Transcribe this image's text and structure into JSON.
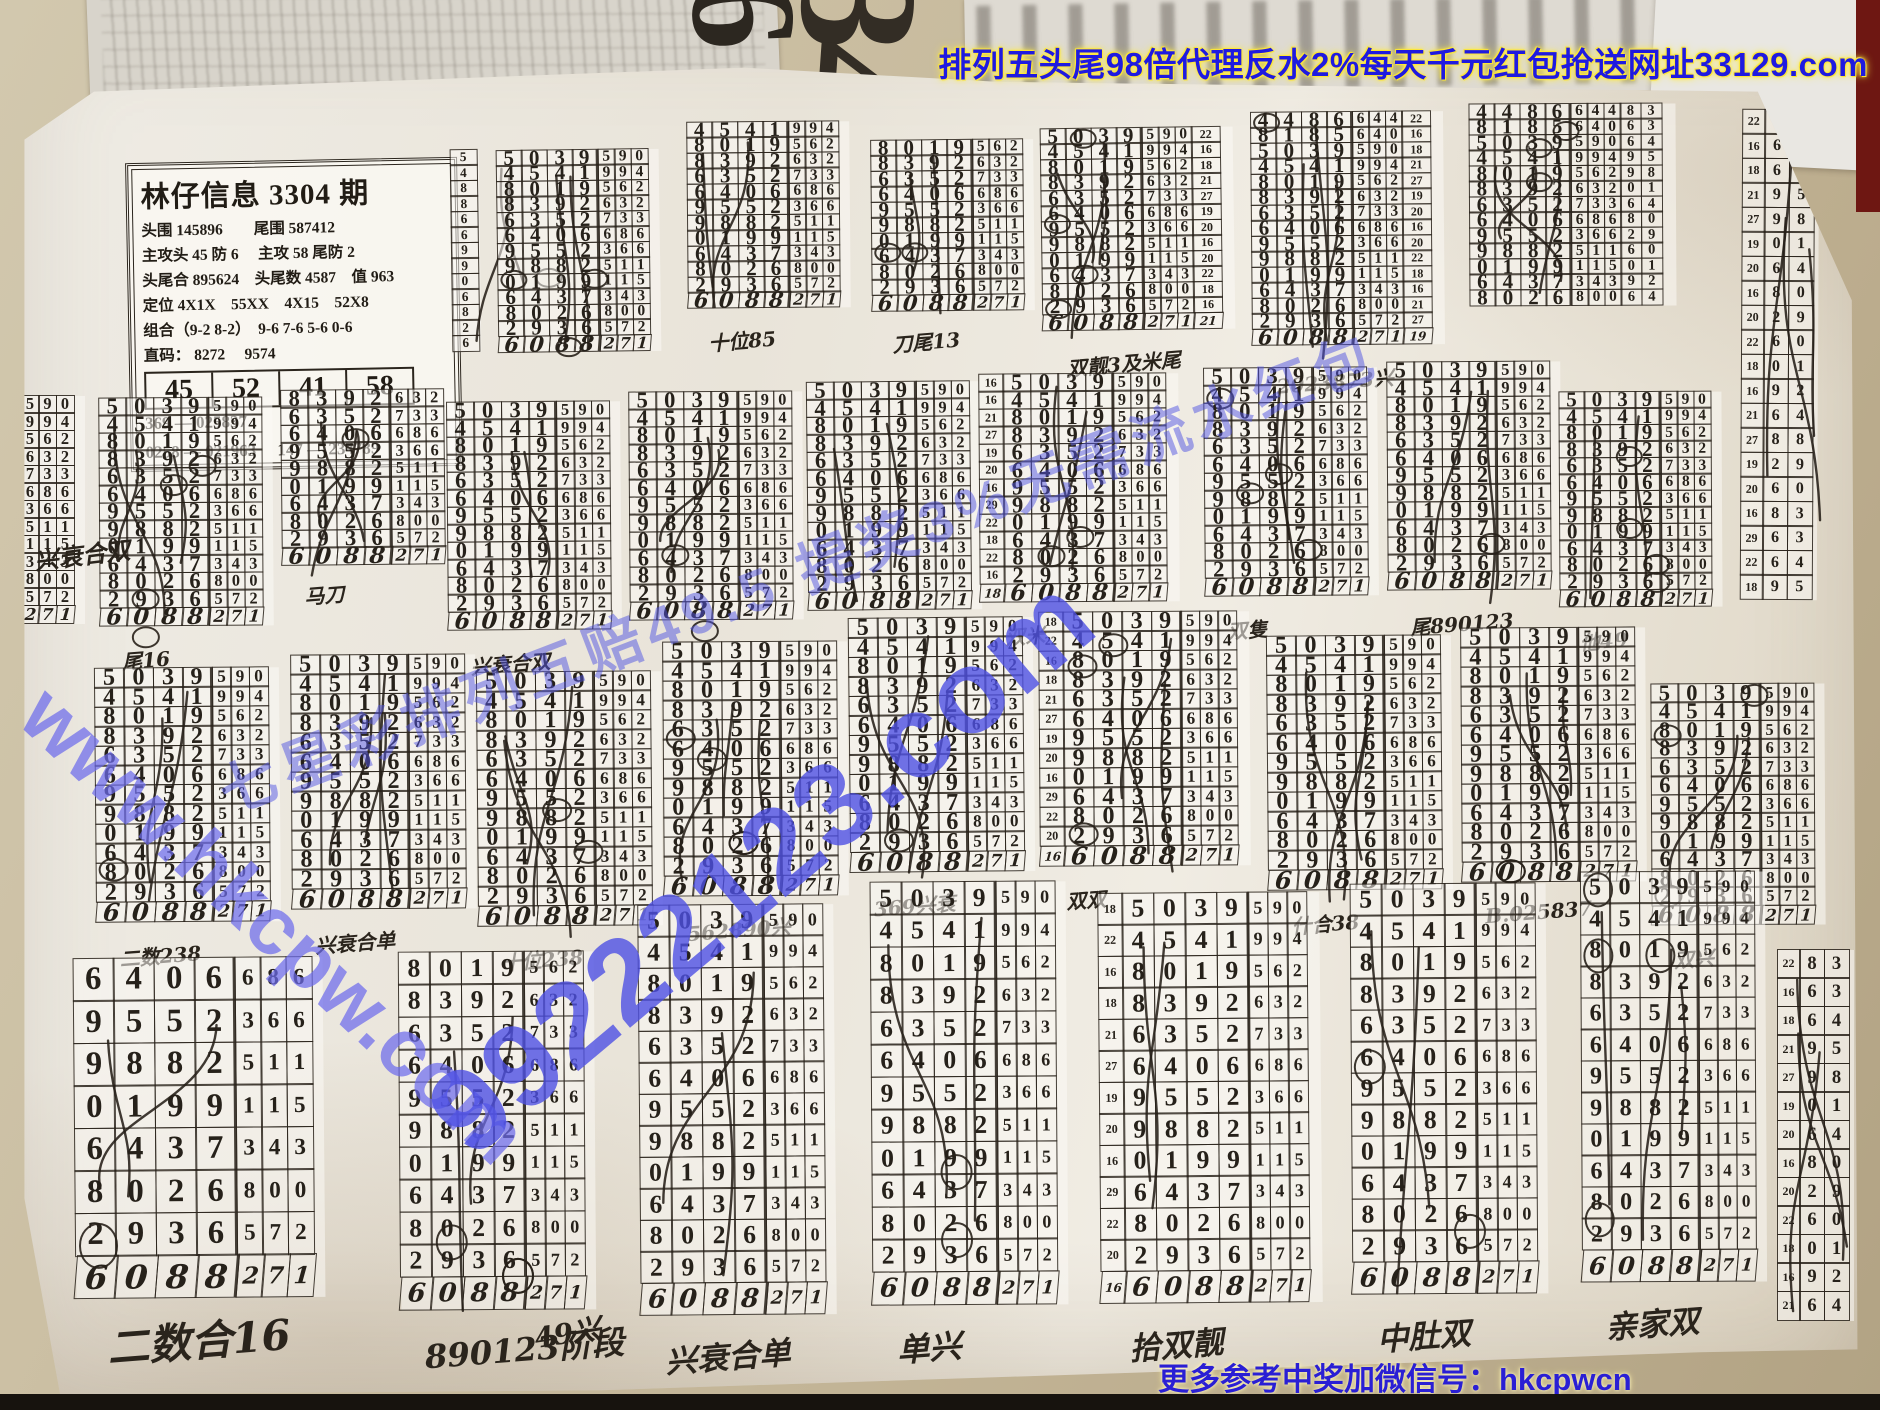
{
  "banner": {
    "text": "排列五头尾98倍代理反水2%每天千元红包抢送网址33129.com"
  },
  "footer": {
    "text": "更多参考中奖加微信号：hkcpwcn"
  },
  "watermarks": {
    "center": "99222123.com",
    "left": "www.hkcpw.com",
    "diagonal": "七星彩排列五赔49.5 提奖3%无需流水红包"
  },
  "scraps": {
    "big_digits": "34",
    "big_six": "6",
    "side_digits": "9 9 9"
  },
  "info_box": {
    "title": "林仔信息 3304 期",
    "lines": [
      "头围 145896　　尾围 587412",
      "主攻头 45 防 6　 主攻 58 尾防 2",
      "头尾合 895624　头尾数 4587　值 963",
      "定位 4X1X　55XX　4X15　52X8",
      "组合（9-2 8-2）　9-6 7-6 5-6 0-6",
      "直码： 8272　 9574"
    ],
    "highlight_cells": [
      "45",
      "52",
      "41",
      "58"
    ],
    "bottom_lines": [
      "369 — 025837",
      "0258 — 021963　 147 — 234789"
    ]
  },
  "grid": {
    "rows": [
      [
        "5",
        "0",
        "3",
        "9",
        "5",
        "9",
        "0"
      ],
      [
        "4",
        "5",
        "4",
        "1",
        "9",
        "9",
        "4"
      ],
      [
        "8",
        "0",
        "1",
        "9",
        "5",
        "6",
        "2"
      ],
      [
        "8",
        "3",
        "9",
        "2",
        "6",
        "3",
        "2"
      ],
      [
        "6",
        "3",
        "5",
        "2",
        "7",
        "3",
        "3"
      ],
      [
        "6",
        "4",
        "0",
        "6",
        "6",
        "8",
        "6"
      ],
      [
        "9",
        "5",
        "5",
        "2",
        "3",
        "6",
        "6"
      ],
      [
        "9",
        "8",
        "8",
        "2",
        "5",
        "1",
        "1"
      ],
      [
        "0",
        "1",
        "9",
        "9",
        "1",
        "1",
        "5"
      ],
      [
        "6",
        "4",
        "3",
        "7",
        "3",
        "4",
        "3"
      ],
      [
        "8",
        "0",
        "2",
        "6",
        "8",
        "0",
        "0"
      ],
      [
        "2",
        "9",
        "3",
        "6",
        "5",
        "7",
        "2"
      ],
      [
        "6",
        "0",
        "8",
        "8",
        "2",
        "7",
        "1"
      ]
    ],
    "prefix_rows": [
      [
        "4",
        "4",
        "8",
        "6",
        "6",
        "4",
        "4"
      ],
      [
        "8",
        "1",
        "8",
        "5",
        "6",
        "4",
        "0"
      ]
    ],
    "index_left_a": [
      16,
      16,
      21,
      27,
      19,
      20,
      16,
      29,
      22,
      18,
      22,
      16,
      18
    ],
    "index_left_b": [
      18,
      22,
      16,
      18,
      21,
      27,
      19,
      20,
      16,
      29,
      22,
      20,
      16
    ],
    "index_right": [
      22,
      16,
      18,
      21,
      27,
      19,
      20,
      16,
      20,
      22,
      18,
      16,
      21,
      27,
      19,
      20,
      16,
      29,
      22,
      18,
      22,
      16,
      18,
      21
    ],
    "side_pairs": [
      [
        "8",
        "3"
      ],
      [
        "6",
        "3"
      ],
      [
        "6",
        "4"
      ],
      [
        "9",
        "5"
      ],
      [
        "9",
        "8"
      ],
      [
        "0",
        "1"
      ],
      [
        "6",
        "4"
      ],
      [
        "8",
        "0"
      ],
      [
        "2",
        "9"
      ],
      [
        "6",
        "0"
      ],
      [
        "0",
        "1"
      ],
      [
        "9",
        "2"
      ],
      [
        "6",
        "4"
      ],
      [
        "8",
        "8"
      ],
      [
        "2",
        "9"
      ],
      [
        "6",
        "0"
      ],
      [
        "8",
        "3"
      ],
      [
        "6",
        "3"
      ],
      [
        "6",
        "4"
      ],
      [
        "9",
        "5"
      ],
      [
        "9",
        "8"
      ],
      [
        "0",
        "1"
      ],
      [
        "2",
        "9"
      ],
      [
        "6",
        "0"
      ]
    ]
  },
  "blocks": [
    {
      "x": 452,
      "y": 150,
      "type": "single",
      "rot": -0.8
    },
    {
      "x": 498,
      "y": 150,
      "rot": -0.8
    },
    {
      "x": 688,
      "y": 122,
      "r0": 1,
      "rot": -0.5,
      "label": "十位85"
    },
    {
      "x": 872,
      "y": 140,
      "r0": 2,
      "rot": -0.6,
      "label": "刀尾13"
    },
    {
      "x": 1042,
      "y": 128,
      "rot": -0.8,
      "idxR": true,
      "label": "双靓3及米尾"
    },
    {
      "x": 1252,
      "y": 112,
      "prefix": true,
      "rot": -0.5,
      "idxR": true,
      "label": "2023873兴"
    },
    {
      "x": 1470,
      "y": 104,
      "prefix": true,
      "r1": 10,
      "rot": -0.3,
      "pairs": true
    },
    {
      "x": 1742,
      "y": 110,
      "type": "pairs",
      "count": 20,
      "rh": 26,
      "rot": 0.3
    },
    {
      "x": -88,
      "y": 396,
      "bw": 29,
      "sw": 19,
      "rh": 19,
      "rot": 0
    },
    {
      "x": 100,
      "y": 398,
      "bw": 29,
      "sw": 19,
      "rh": 19,
      "rot": -0.4,
      "label": "尾16"
    },
    {
      "x": 282,
      "y": 390,
      "bw": 29,
      "sw": 19,
      "rh": 19,
      "r0": 3,
      "rot": -0.6,
      "label": "马刀"
    },
    {
      "x": 448,
      "y": 402,
      "bw": 29,
      "sw": 19,
      "rh": 19,
      "rot": -0.5,
      "label": "兴衰合双"
    },
    {
      "x": 630,
      "y": 392,
      "bw": 29,
      "sw": 19,
      "rh": 19,
      "rot": -0.4
    },
    {
      "x": 808,
      "y": 382,
      "bw": 29,
      "sw": 19,
      "rh": 19,
      "rot": -0.6
    },
    {
      "x": 980,
      "y": 374,
      "bw": 29,
      "sw": 19,
      "rh": 19,
      "idxL": "a",
      "rot": -0.4,
      "label": "双米"
    },
    {
      "x": 1205,
      "y": 368,
      "bw": 29,
      "sw": 19,
      "rh": 19,
      "rot": -0.5,
      "label": "双隻"
    },
    {
      "x": 1388,
      "y": 362,
      "bw": 29,
      "sw": 19,
      "rh": 19,
      "rot": -0.4,
      "label": "尾890123"
    },
    {
      "x": 1560,
      "y": 392,
      "bw": 27,
      "sw": 18,
      "rh": 18,
      "rot": -0.3,
      "label": "他49"
    },
    {
      "x": 96,
      "y": 668,
      "bw": 31,
      "sw": 20,
      "rh": 21,
      "rot": -0.5,
      "label": "二数238"
    },
    {
      "x": 292,
      "y": 655,
      "bw": 31,
      "sw": 20,
      "rh": 21,
      "rot": -0.4,
      "label": "兴衰合单"
    },
    {
      "x": 478,
      "y": 672,
      "bw": 31,
      "sw": 20,
      "rh": 21,
      "rot": -0.5,
      "label": "十位238"
    },
    {
      "x": 664,
      "y": 642,
      "bw": 31,
      "sw": 20,
      "rh": 21,
      "rot": -0.4,
      "label": "562890兴"
    },
    {
      "x": 850,
      "y": 618,
      "bw": 31,
      "sw": 20,
      "rh": 21,
      "rot": -0.6,
      "label": "369兴衰"
    },
    {
      "x": 1040,
      "y": 612,
      "bw": 31,
      "sw": 20,
      "rh": 21,
      "idxL": "b",
      "rot": -0.4,
      "label": "双双"
    },
    {
      "x": 1268,
      "y": 636,
      "bw": 31,
      "sw": 20,
      "rh": 21,
      "rot": -0.5,
      "label": "什合38"
    },
    {
      "x": 1462,
      "y": 628,
      "bw": 31,
      "sw": 20,
      "rh": 21,
      "rot": -0.4,
      "label": "B.025837"
    },
    {
      "x": 1652,
      "y": 684,
      "bw": 29,
      "sw": 19,
      "rh": 20,
      "rot": -0.3,
      "label": "双兴"
    },
    {
      "x": 75,
      "y": 958,
      "bw": 42,
      "sw": 27,
      "rh": 44,
      "r0": 5,
      "rot": -0.5,
      "label": "二数合16"
    },
    {
      "x": 400,
      "y": 952,
      "bw": 33,
      "sw": 21,
      "rh": 34,
      "r0": 2,
      "rot": -0.4,
      "label": "890123阶段"
    },
    {
      "x": 640,
      "y": 905,
      "bw": 33,
      "sw": 21,
      "rh": 33,
      "rot": -0.5,
      "label": "兴衰合单"
    },
    {
      "x": 872,
      "y": 882,
      "bw": 33,
      "sw": 21,
      "rh": 34,
      "rot": -0.4,
      "label": "单兴"
    },
    {
      "x": 1100,
      "y": 893,
      "bw": 33,
      "sw": 21,
      "rh": 33,
      "idxL": "b",
      "rot": -0.5,
      "label": "拾双靓"
    },
    {
      "x": 1352,
      "y": 884,
      "bw": 33,
      "sw": 21,
      "rh": 33,
      "rot": -0.4,
      "label": "中肚双"
    },
    {
      "x": 1582,
      "y": 872,
      "bw": 31,
      "sw": 20,
      "rh": 33,
      "rot": -0.3,
      "label": "亲家双"
    },
    {
      "x": 1778,
      "y": 950,
      "type": "pairs",
      "count": 13,
      "rh": 30,
      "rot": 0
    }
  ],
  "annotations": [
    {
      "text": "兴衰合双",
      "x": 34,
      "y": 536,
      "rot": -7,
      "size": 24
    },
    {
      "text": "49兴",
      "x": 534,
      "y": 1312,
      "rot": -9,
      "size": 28
    },
    {
      "text": "单数双",
      "x": 1672,
      "y": 1348,
      "rot": -6,
      "size": 26
    }
  ],
  "colors": {
    "ink": "#2b251d",
    "paper": "#ece8df",
    "desk": "#c7bba0",
    "banner_blue": "#1f1ae0",
    "glow_yellow": "#ffe93c",
    "watermark_blue": "#5457e2",
    "red_strip": "#6e1712"
  }
}
